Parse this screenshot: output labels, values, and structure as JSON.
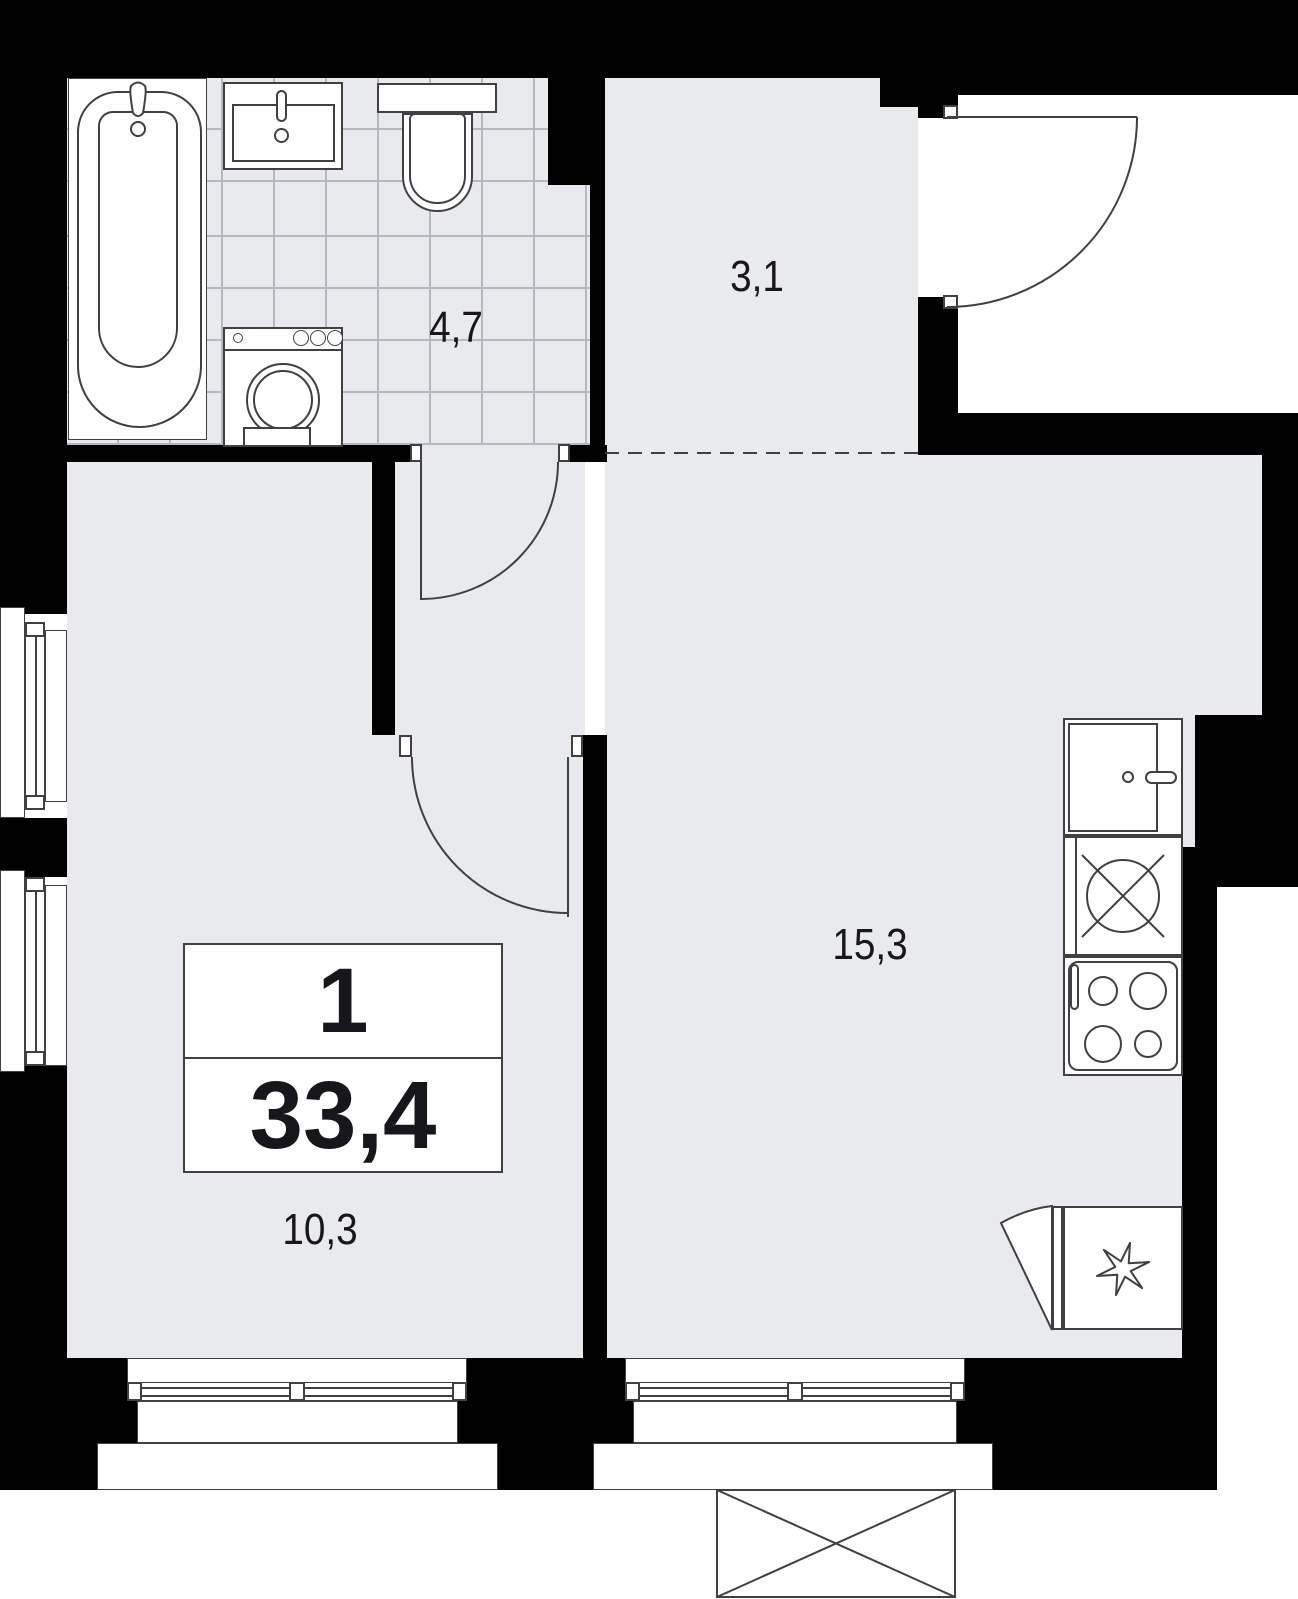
{
  "plan_title": "apartment-floor-plan",
  "info_box": {
    "room_count": "1",
    "total_area": "33,4"
  },
  "rooms": {
    "hallway": {
      "label": "3,1"
    },
    "bathroom": {
      "label": "4,7"
    },
    "kitchen_living": {
      "label": "15,3"
    },
    "bedroom": {
      "label": "10,3"
    }
  },
  "icons": {
    "fridge": "snowflake-icon",
    "hob": "crossed-circle-icon",
    "balcony_basket": "crossed-box-icon"
  },
  "colors": {
    "wall": "#000000",
    "floor": "#e8eaee",
    "tile_line": "#b4b8c0",
    "stroke": "#3f3f44",
    "text": "#17171b"
  }
}
